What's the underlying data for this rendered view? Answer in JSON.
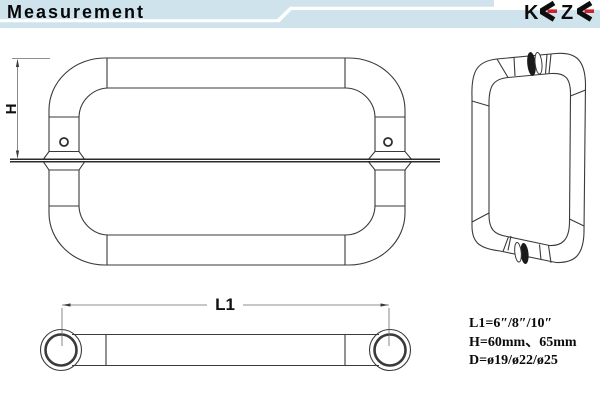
{
  "header": {
    "title": "Measurement",
    "logo": {
      "text": "KEZE",
      "k": "K",
      "z": "Z"
    }
  },
  "front_view": {
    "height_label": "H"
  },
  "bottom_view": {
    "length_label": "L1"
  },
  "specs": {
    "lines": [
      "L1=6″/8″/10″",
      "H=60mm、65mm",
      "D=ø19/ø22/ø25"
    ]
  },
  "colors": {
    "header_band": "#cfe3ed",
    "logo_red": "#cc2229",
    "line": "#3a3a3a",
    "glass_line": "#2b2b2b"
  }
}
